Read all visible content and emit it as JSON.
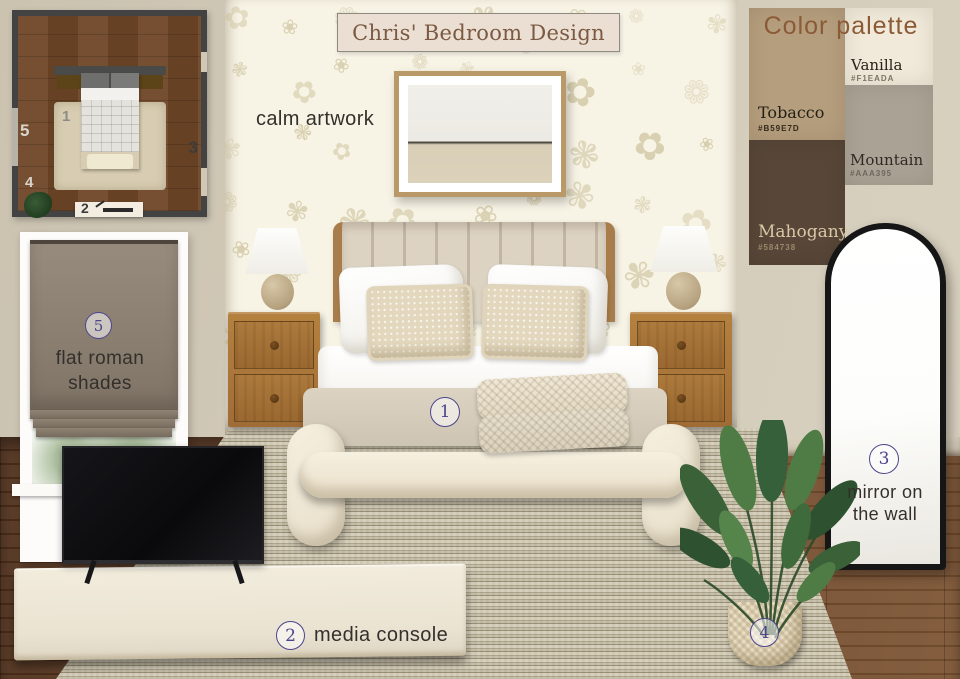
{
  "title": "Chris' Bedroom Design",
  "artwork": {
    "label": "calm artwork"
  },
  "palette": {
    "heading": "Color palette",
    "tobacco": {
      "name": "Tobacco",
      "hex": "#B59E7D"
    },
    "vanilla": {
      "name": "Vanilla",
      "hex": "#F1EADA"
    },
    "mountain": {
      "name": "Mountain",
      "hex": "#AAA395"
    },
    "mahogany": {
      "name": "Mahogany",
      "hex": "#584738"
    }
  },
  "annotations": {
    "bed": {
      "num": "1"
    },
    "console": {
      "num": "2",
      "label": "media console"
    },
    "mirror": {
      "num": "3",
      "line1": "mirror on",
      "line2": "the wall"
    },
    "plant": {
      "num": "4"
    },
    "shades": {
      "num": "5",
      "line1": "flat roman",
      "line2": "shades"
    }
  },
  "floorplan": {
    "bed": "1",
    "console": "2",
    "mirror": "3",
    "plant": "4",
    "window": "5"
  },
  "colors": {
    "accent": "#4C458C",
    "wall": "#CFC7B5",
    "wallpaper": "#F7F3E5",
    "floor": "#5E3B24",
    "palette_heading": "#8B5A36",
    "tobacco": "#B59E7D",
    "vanilla": "#F1EADA",
    "mountain": "#AAA395",
    "mahogany": "#584738"
  }
}
